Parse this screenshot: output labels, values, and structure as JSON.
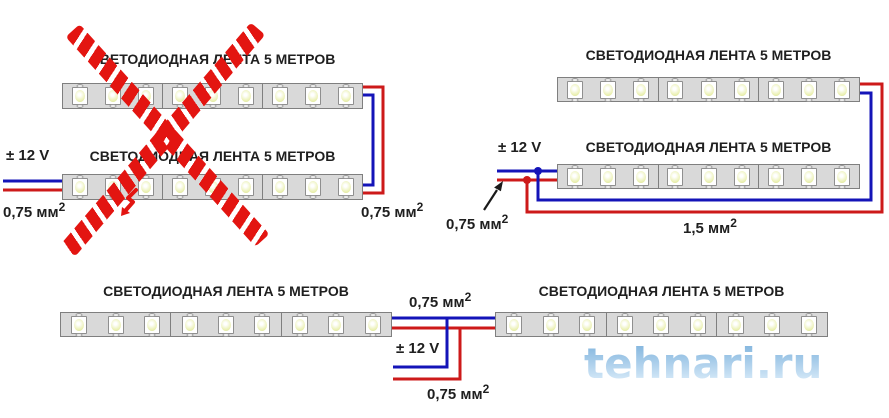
{
  "strip_spec": {
    "segments": 3,
    "leds_per_segment": 3
  },
  "diagrams": {
    "series_wrong": {
      "crossed_out": true,
      "strip1_title": "СВЕТОДИОДНАЯ ЛЕНТА 5 МЕТРОВ",
      "strip2_title": "СВЕТОДИОДНАЯ ЛЕНТА 5 МЕТРОВ",
      "voltage": "± 12 V",
      "input_gauge": {
        "value": "0,75 мм",
        "sup": "2"
      },
      "link_gauge": {
        "value": "0,75 мм",
        "sup": "2"
      }
    },
    "parallel": {
      "crossed_out": false,
      "strip1_title": "СВЕТОДИОДНАЯ ЛЕНТА 5 МЕТРОВ",
      "strip2_title": "СВЕТОДИОДНАЯ ЛЕНТА 5 МЕТРОВ",
      "voltage": "± 12 V",
      "input_gauge": {
        "value": "0,75 мм",
        "sup": "2"
      },
      "run_gauge": {
        "value": "1,5 мм",
        "sup": "2"
      }
    },
    "center_feed": {
      "crossed_out": false,
      "strip1_title": "СВЕТОДИОДНАЯ ЛЕНТА 5 МЕТРОВ",
      "strip2_title": "СВЕТОДИОДНАЯ ЛЕНТА 5 МЕТРОВ",
      "voltage": "± 12 V",
      "link_gauge": {
        "value": "0,75 мм",
        "sup": "2"
      },
      "feed_gauge": {
        "value": "0,75 мм",
        "sup": "2"
      }
    }
  },
  "watermark": {
    "text": "tehnari.ru"
  },
  "colors": {
    "wire-blue": "#1414b8",
    "wire-red": "#cd1a1a",
    "cross-red": "#e31511",
    "strip-fill": "#d9d9d9",
    "strip-border": "#7f7f7f",
    "led-fill": "#ffffff",
    "led-glow": "#e9efad",
    "label-text": "#1f1f1f",
    "watermark-blue": "#9cc6e8"
  }
}
